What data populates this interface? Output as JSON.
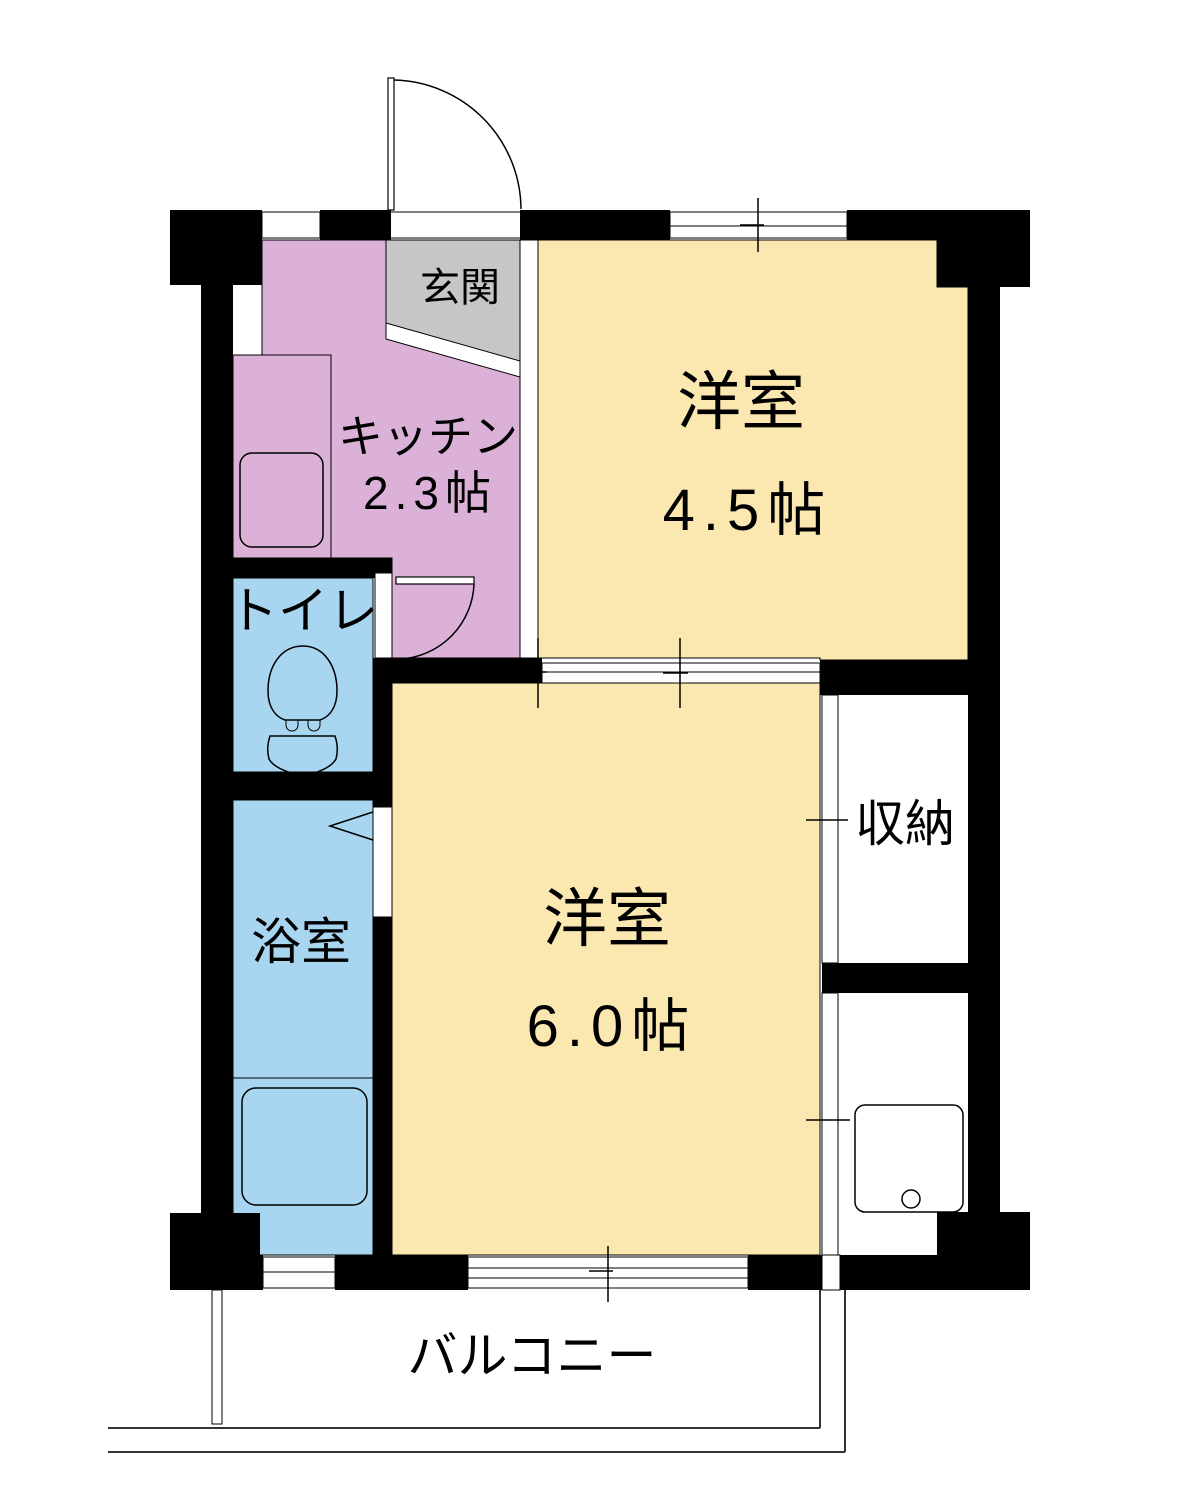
{
  "plan": {
    "title": "1K apartment floor plan",
    "colors": {
      "wall": "#000000",
      "floor_cream": "#fbe7b0",
      "floor_pink": "#dbb1d8",
      "floor_blue": "#a8d6f0",
      "floor_gray": "#c6c6c6",
      "line": "#000000"
    },
    "rooms": [
      {
        "key": "genkan",
        "label": "玄関"
      },
      {
        "key": "kitchen",
        "label": "キッチン",
        "size": "2.3帖"
      },
      {
        "key": "room45",
        "label": "洋室",
        "size": "4.5帖"
      },
      {
        "key": "room60",
        "label": "洋室",
        "size": "6.0帖"
      },
      {
        "key": "toilet",
        "label": "トイレ"
      },
      {
        "key": "bathroom",
        "label": "浴室"
      },
      {
        "key": "storage",
        "label": "収納"
      },
      {
        "key": "balcony",
        "label": "バルコニー"
      }
    ]
  }
}
